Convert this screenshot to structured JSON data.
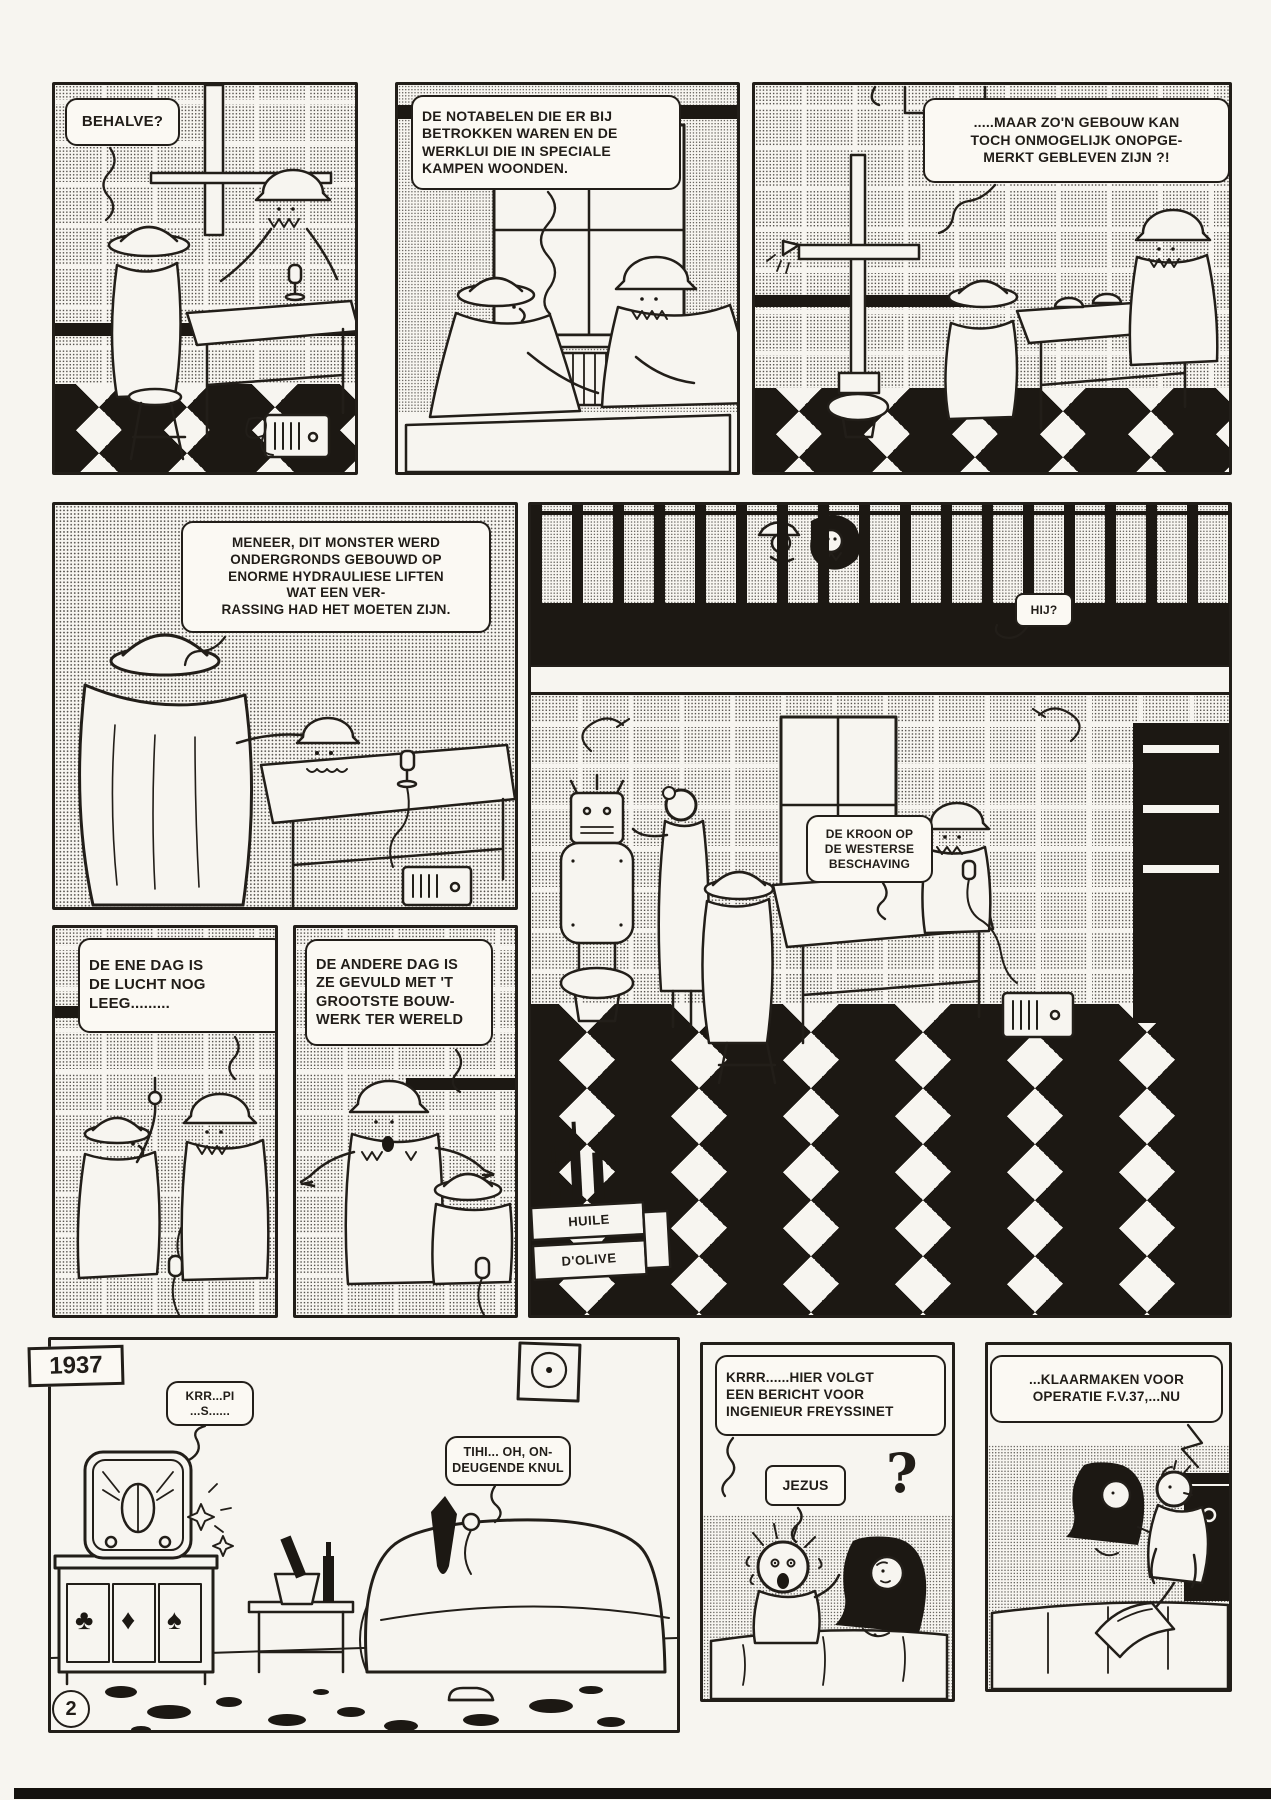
{
  "colors": {
    "ink": "#221e19",
    "paper": "#f7f5f0"
  },
  "page": {
    "year_badge": "1937",
    "page_number": "2"
  },
  "panels": {
    "p1": {
      "bubble": "BEHALVE?"
    },
    "p2": {
      "bubble": "DE NOTABELEN DIE ER BIJ\nBETROKKEN WAREN EN DE\nWERKLUI DIE IN SPECIALE\nKAMPEN WOONDEN."
    },
    "p3": {
      "bubble": ".....MAAR ZO'N GEBOUW KAN\nTOCH ONMOGELIJK ONOPGE-\nMERKT GEBLEVEN ZIJN ?!"
    },
    "p4": {
      "bubble": "MENEER, DIT MONSTER WERD\nONDERGRONDS GEBOUWD OP\nENORME HYDRAULIESE LIFTEN\nWAT EEN VER-\nRASSING HAD HET MOETEN ZIJN."
    },
    "p5": {
      "guard_bubble": "HIJ?",
      "crown_bubble": "DE KROON OP\nDE WESTERSE\nBESCHAVING",
      "crate_label_top": "HUILE",
      "crate_label_bottom": "D'OLIVE"
    },
    "p6": {
      "bubble": "DE ENE DAG IS\nDE LUCHT NOG\nLEEG........."
    },
    "p7": {
      "bubble": "DE ANDERE DAG IS\nZE GEVULD MET 'T\nGROOTSTE BOUW-\nWERK TER WERELD"
    },
    "p8": {
      "radio_bubble": "KRR...PI\n...S......",
      "sofa_bubble": "TIHI... OH, ON-\nDEUGENDE KNUL",
      "cabinet_suits": [
        "♣",
        "♦",
        "♠"
      ]
    },
    "p9": {
      "radio_bubble": "KRRR......HIER VOLGT\nEEN BERICHT VOOR\nINGENIEUR FREYSSINET",
      "jezus_bubble": "JEZUS",
      "question_mark": "?"
    },
    "p10": {
      "bubble": "...KLAARMAKEN VOOR\nOPERATIE F.V.37,...NU"
    }
  }
}
